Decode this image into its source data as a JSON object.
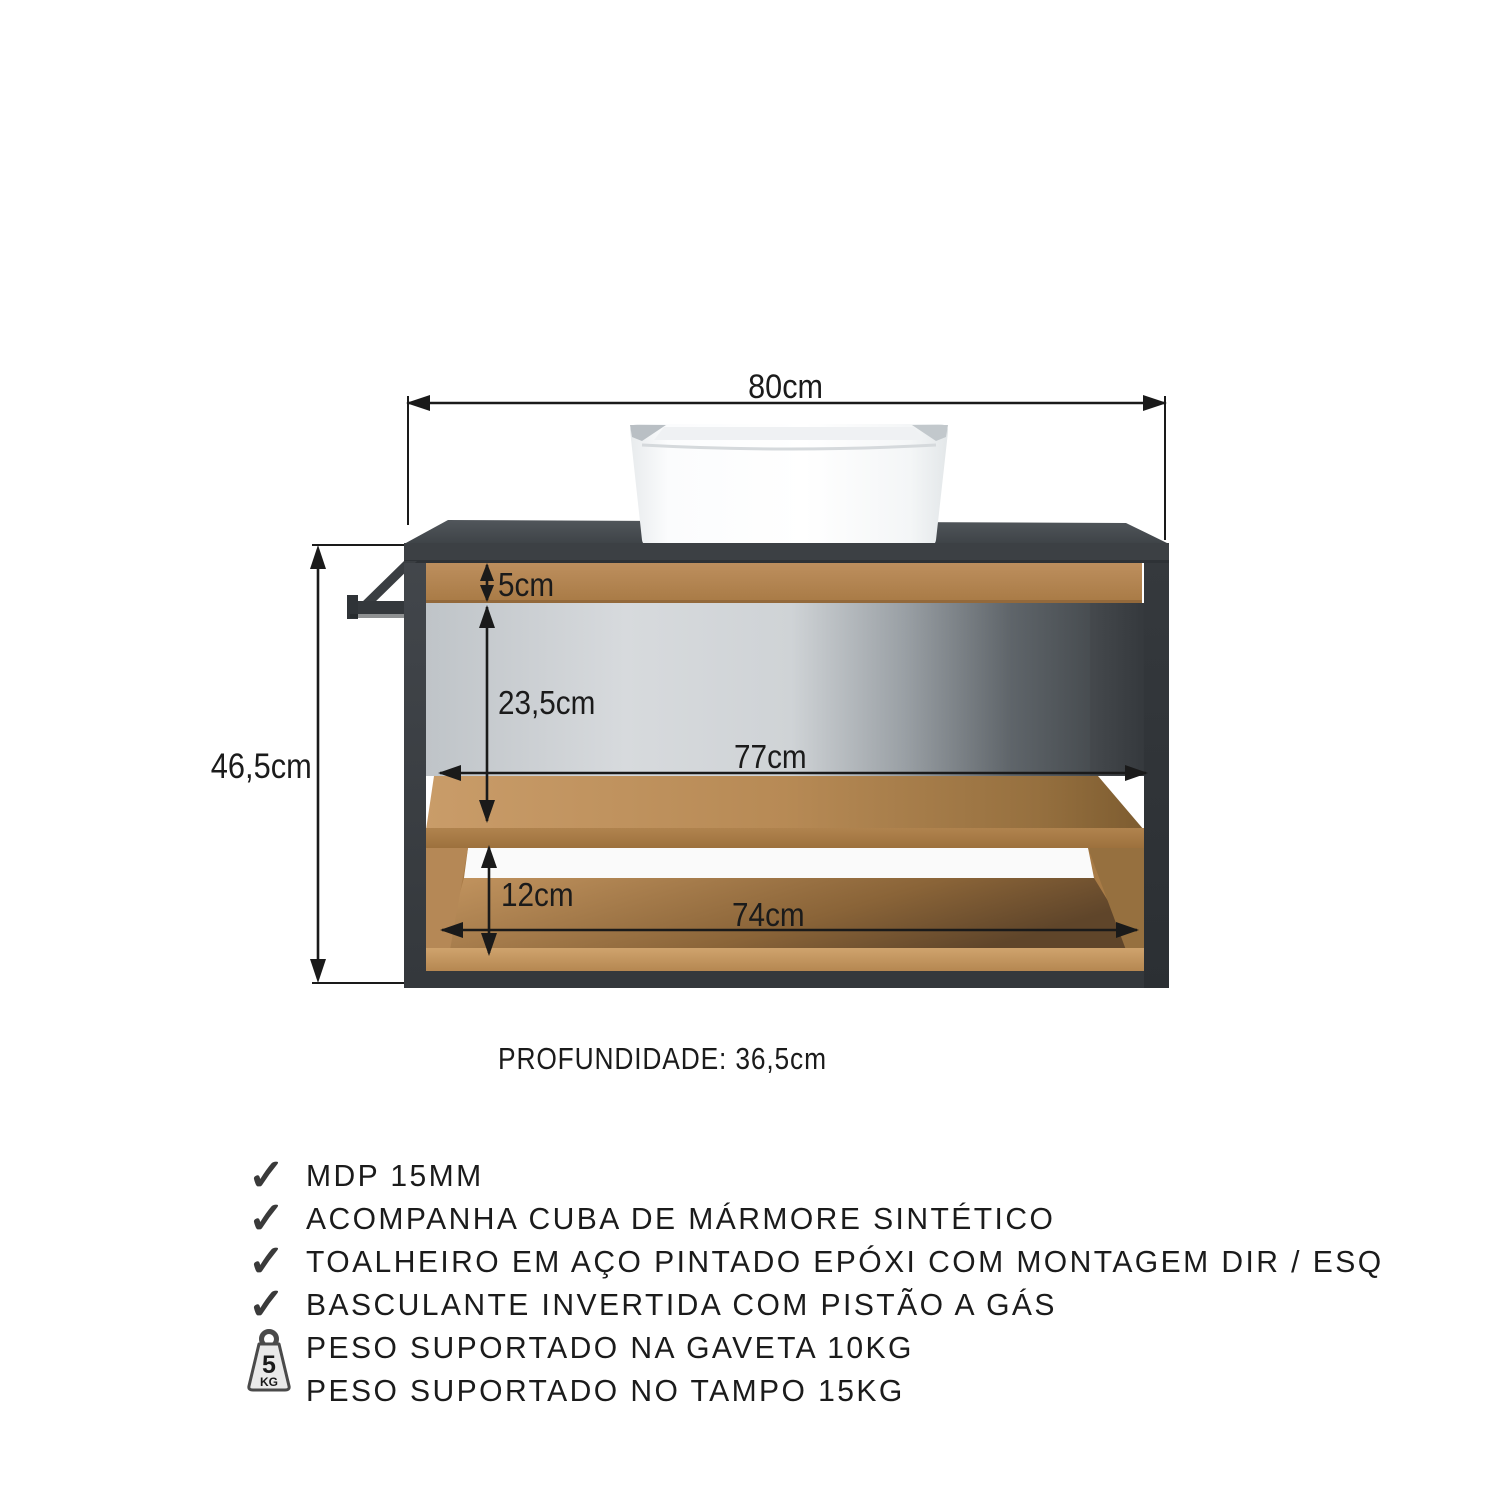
{
  "diagram": {
    "dim_width_top": "80cm",
    "dim_height_left": "46,5cm",
    "dim_drawer_height": "5cm",
    "dim_niche_height": "23,5cm",
    "dim_niche_width": "77cm",
    "dim_lower_niche_height": "12cm",
    "dim_lower_niche_width": "74cm",
    "depth_label": "PROFUNDIDADE: 36,5cm"
  },
  "features": {
    "check_glyph": "✓",
    "weight_badge": {
      "value": "5",
      "unit": "KG"
    },
    "items": [
      {
        "icon": "check",
        "label": "MDP 15MM"
      },
      {
        "icon": "check",
        "label": "ACOMPANHA CUBA DE MÁRMORE SINTÉTICO"
      },
      {
        "icon": "check",
        "label": "TOALHEIRO EM AÇO PINTADO EPÓXI COM MONTAGEM DIR / ESQ"
      },
      {
        "icon": "check",
        "label": "BASCULANTE INVERTIDA COM PISTÃO A GÁS"
      },
      {
        "icon": "weight",
        "label": "PESO SUPORTADO NA GAVETA 10KG"
      },
      {
        "icon": "weight",
        "label": "PESO SUPORTADO NO TAMPO 15KG"
      }
    ]
  },
  "colors": {
    "cabinet_gray": "#3a3e42",
    "wood": "#b08450",
    "interior_light": "#d7dadd",
    "line": "#1a1a1a",
    "sink_white": "#ffffff"
  }
}
